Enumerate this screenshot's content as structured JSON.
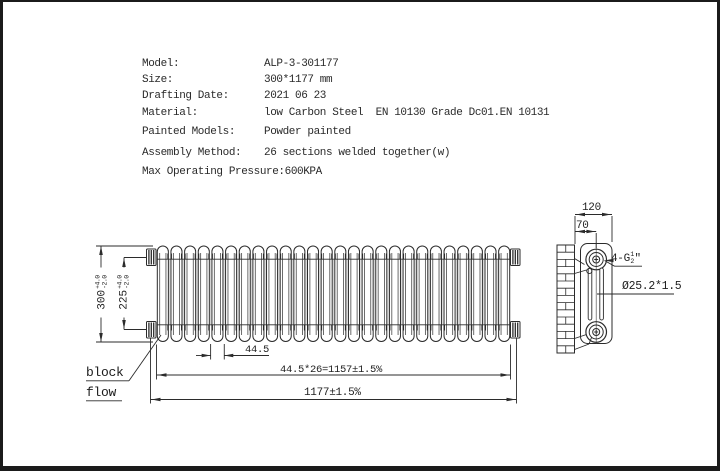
{
  "specs": {
    "rows": [
      {
        "label": "Model:",
        "value": "ALP-3-301177"
      },
      {
        "label": "Size:",
        "value": "300*1177 mm"
      },
      {
        "label": "Drafting Date:",
        "value": "2021 06 23"
      },
      {
        "label": "Material:",
        "value": "low Carbon Steel  EN 10130 Grade Dc01.EN 10131"
      },
      {
        "label": "Painted Models:",
        "value": "Powder painted"
      },
      {
        "label": "Assembly Method:",
        "value": "26 sections welded together(w)"
      },
      {
        "label": "Max Operating Pressure:",
        "value": "600KPA"
      }
    ]
  },
  "front_view": {
    "sections": 26,
    "dims": {
      "height": "300",
      "height_tol_plus": "+4.0",
      "height_tol_minus": "-2.0",
      "inner": "225",
      "inner_tol_plus": "+4.0",
      "inner_tol_minus": "-2.0",
      "section_pitch": "44.5",
      "sections_total": "44.5*26=1157±1.5%",
      "overall_width": "1177±1.5%"
    },
    "note_line1": "block",
    "note_line2": "flow"
  },
  "side_view": {
    "dims": {
      "depth": "120",
      "pipe_offset": "70",
      "thread_prefix": "4-G",
      "thread_numerator": "1",
      "thread_denominator": "2",
      "thread_suffix": "\"",
      "pipe_size": "Ø25.2*1.5"
    }
  },
  "colors": {
    "line": "#2b2b2b",
    "shade": "#c9c9c9",
    "tube_shade": "#e2e2e2"
  }
}
